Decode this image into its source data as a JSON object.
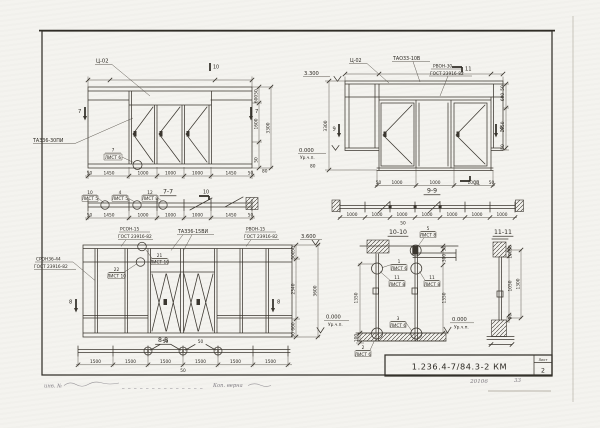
{
  "sheet": {
    "code": "1.236.4-7/84.3-2 КМ",
    "sheet_label": "Лист",
    "sheet_number": "2",
    "stamp_number": "20106",
    "stamp_page": "33",
    "note_left": "инв. №",
    "note_right": "Коп. верна"
  },
  "tl": {
    "label_c02": "Ц-02",
    "label_product": "ТАЗ36-30ПИ",
    "marker_left": "7",
    "marker_right": "7",
    "marker_top": "10",
    "marker_plan": "10",
    "flag_num": "7",
    "flag_sheet": "ЛИСТ 6",
    "dims_bottom": [
      "50",
      "1450",
      "1000",
      "1000",
      "1000",
      "1450",
      "50"
    ],
    "dims_right": [
      "50",
      "600",
      "1600",
      "50"
    ],
    "dim_height": "3300",
    "dim_80": "80",
    "plan_title": "7-7",
    "plan_flags": [
      {
        "num": "10",
        "sheet": "ЛИСТ 5"
      },
      {
        "num": "4",
        "sheet": "ЛИСТ 5"
      },
      {
        "num": "12",
        "sheet": "ЛИСТ 8"
      }
    ],
    "plan_dims": [
      "50",
      "1450",
      "1000",
      "1000",
      "1000",
      "1450",
      "50"
    ]
  },
  "tr": {
    "label_c02": "Ц-02",
    "label_ta": "ТАО33-10В",
    "label_rv": "РВОН-30",
    "label_gost": "ГОСТ 23916-82",
    "level_top": "3.300",
    "level_bottom": "0.000",
    "level_note": "Ур.ч.п.",
    "dim_height": "3300",
    "dim_80": "80",
    "marker_9l": "9",
    "marker_9r": "9",
    "marker_11t": "11",
    "marker_11b": "11",
    "dims_right": [
      "50",
      "600",
      "1050",
      "50"
    ],
    "dims_bottom": [
      "50",
      "1000",
      "1000",
      "1000",
      "50"
    ],
    "plan_title": "9-9",
    "plan_dims": [
      "1000",
      "1000",
      "1000",
      "1000",
      "1000",
      "1000",
      "1000"
    ],
    "plan_offset": "50",
    "flag_num": "5",
    "flag_sheet": "ЛИСТ 8"
  },
  "bl": {
    "label_rs": "РСОН-15",
    "label_rs_gost": "ГОСТ 23916-82",
    "label_ta": "ТАЗ36-15ВИ",
    "label_r": "РВОН-15",
    "label_r_gost": "ГОСТ 23916-82",
    "label_sr": "СРОН36-44",
    "label_sr_gost": "ГОСТ 23916-82",
    "flag21_num": "21",
    "flag21_sheet": "ЛИСТ 10",
    "flag22_num": "22",
    "flag22_sheet": "ЛИСТ 10",
    "marker_left": "8",
    "marker_right": "8",
    "level_top": "3.600",
    "level_bottom": "0.000",
    "level_note": "Ур.ч.п.",
    "dims_right": [
      "50",
      "500",
      "2340",
      "660",
      "50"
    ],
    "dim_height": "3600",
    "plan_title": "8-8",
    "plan_dims": [
      "1500",
      "1500",
      "1500",
      "1500",
      "1500",
      "1500"
    ],
    "plan_offset": "50",
    "plan_gap_a": "50",
    "plan_gap_b": "50"
  },
  "d10": {
    "title": "10-10",
    "flag1_num": "1",
    "flag1_sheet": "ЛИСТ 6",
    "flag11l_num": "11",
    "flag11l_sheet": "ЛИСТ 8",
    "flag11r_num": "11",
    "flag11r_sheet": "ЛИСТ 8",
    "flag3_num": "3",
    "flag3_sheet": "ЛИСТ 6",
    "flag2_num": "2",
    "flag2_sheet": "ЛИСТ 6",
    "level": "0.000",
    "level_note": "Ур.ч.п.",
    "dim_1350l": "1350",
    "dim_100": "100",
    "dim_50": "50",
    "dim_300": "300",
    "dim_1350r": "1350"
  },
  "d11": {
    "title": "11-11",
    "dims": [
      "50",
      "100",
      "1050",
      "50"
    ],
    "dim_total": "1300"
  }
}
